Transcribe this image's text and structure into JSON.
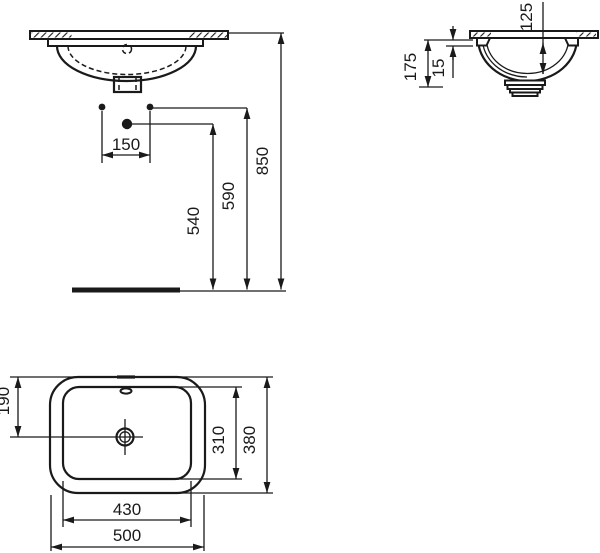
{
  "colors": {
    "background": "#ffffff",
    "line": "#1a1a1a"
  },
  "views": {
    "front": {
      "dims": {
        "fixing_spacing": "150",
        "drain_height": "540",
        "fixing_height": "590",
        "rim_height": "850"
      }
    },
    "side": {
      "dims": {
        "bowl_depth": "125",
        "total_height": "175",
        "rim_gap": "15"
      }
    },
    "top": {
      "dims": {
        "drain_offset": "190",
        "inner_length": "310",
        "outer_length": "380",
        "inner_width": "430",
        "outer_width": "500"
      }
    }
  }
}
